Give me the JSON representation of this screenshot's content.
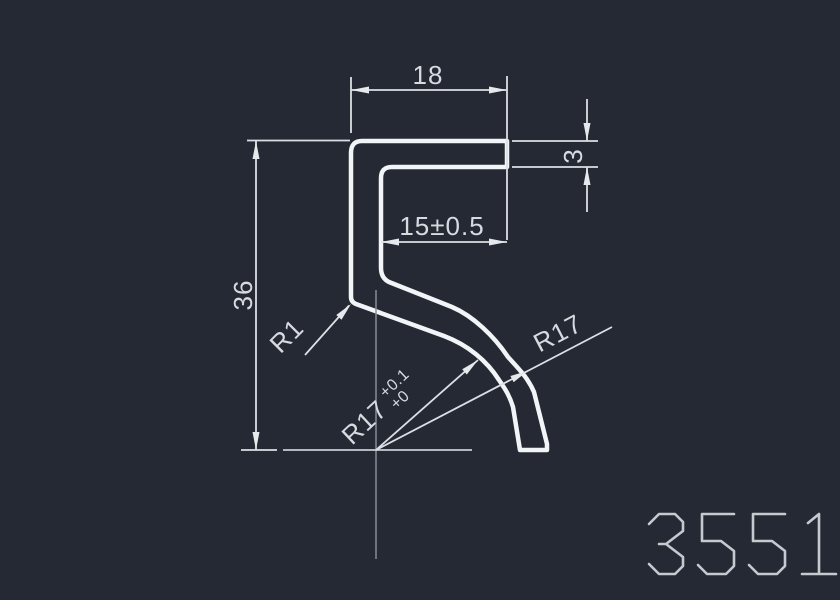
{
  "canvas": {
    "background": "#242933",
    "profile_color": "#f2f5f7",
    "dimension_color": "#dcdfe3",
    "centerline_color": "#878d96",
    "part_number_color": "#c5cacf"
  },
  "dimensions": {
    "top_width": "18",
    "tab_thickness": "3",
    "inner_width": "15±0.5",
    "height": "36",
    "corner_radius": "R1",
    "bend_radius_toleranced": {
      "base": "R17",
      "tol_upper": "+0.1",
      "tol_lower": "+0"
    },
    "bend_radius": "R17"
  },
  "part_number": "3551"
}
